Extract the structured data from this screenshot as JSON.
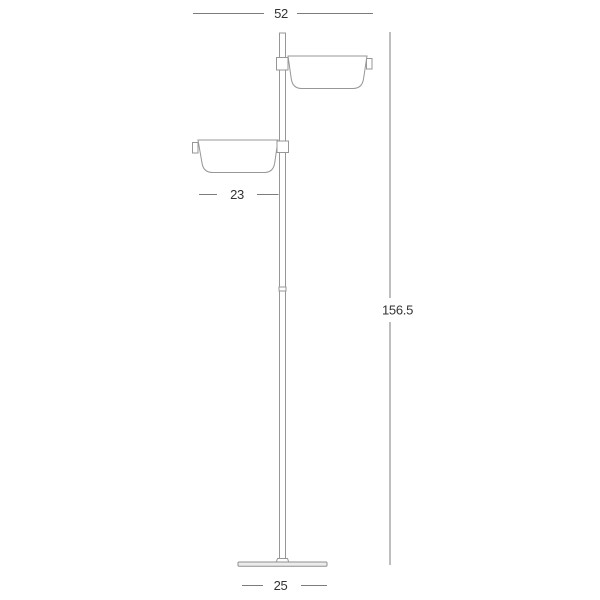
{
  "drawing": {
    "subject": "floor lamp with two rectangular shades, technical dimension drawing",
    "colors": {
      "line": "#979797",
      "dimension_line": "#7c7c7c",
      "text": "#333333",
      "background": "#ffffff"
    },
    "dimensions": {
      "top_width": "52",
      "left_shade_width": "23",
      "total_height": "156.5",
      "base_width": "25"
    }
  }
}
